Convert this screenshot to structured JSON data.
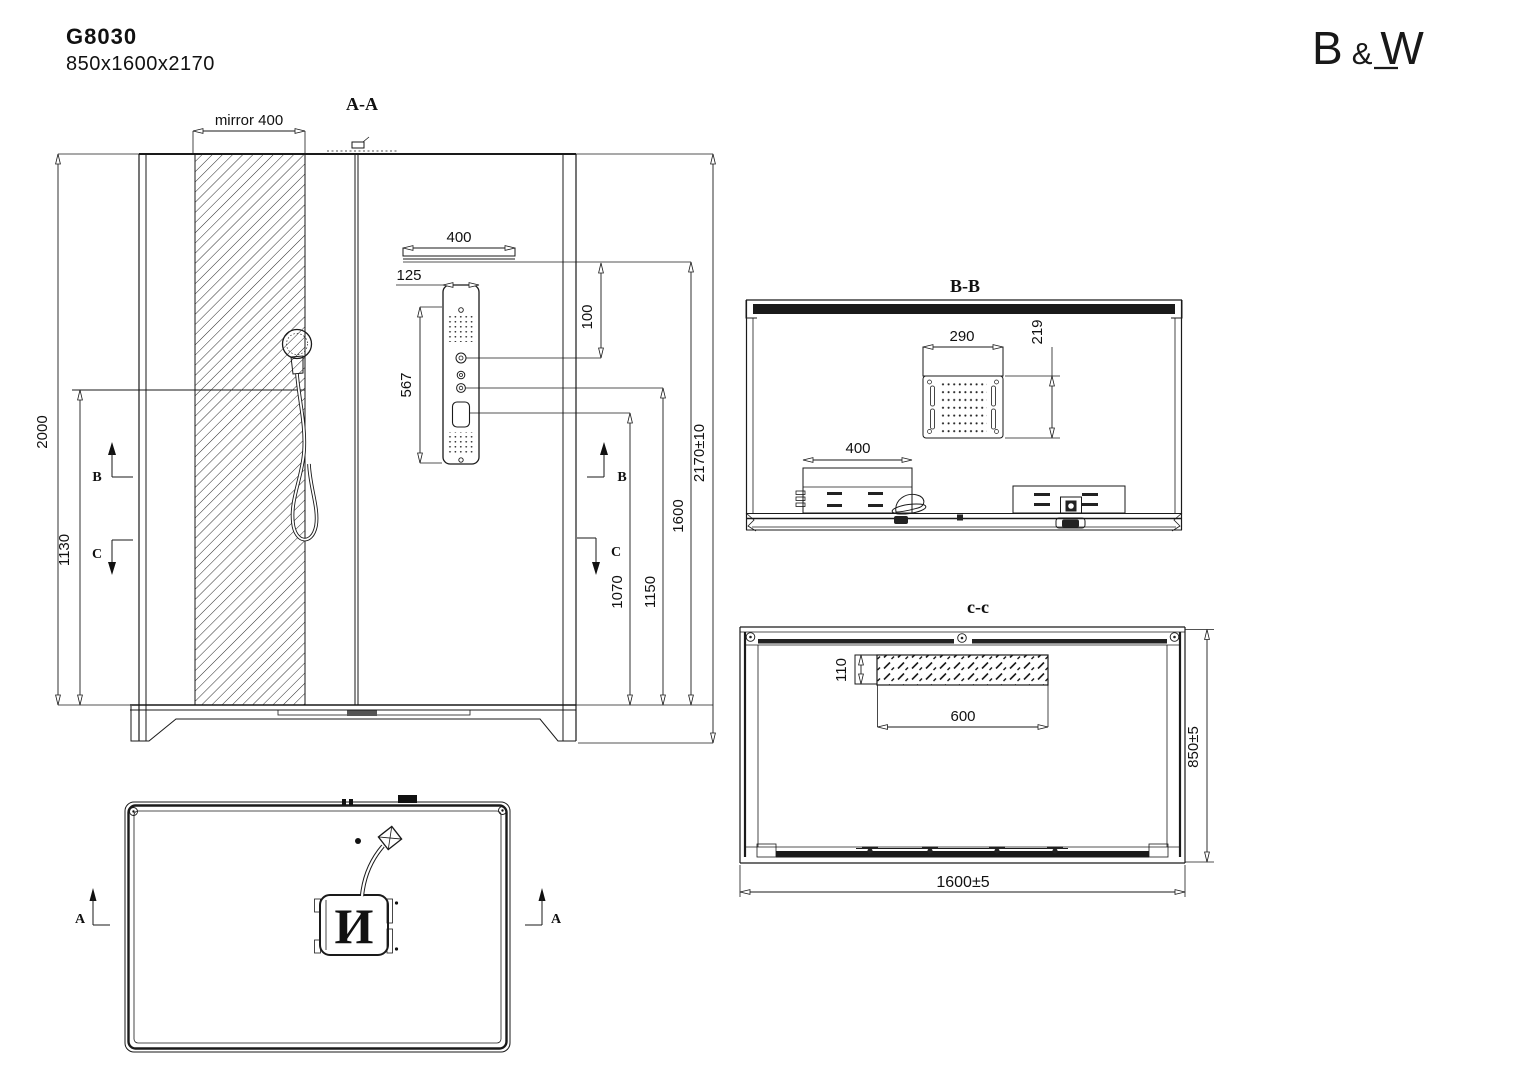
{
  "header": {
    "model": "G8030",
    "size": "850x1600x2170"
  },
  "logo": {
    "letter_b": "B",
    "ampersand": "&",
    "letter_w": "W"
  },
  "front_view": {
    "label": "A-A",
    "mirror_label": "mirror 400",
    "dims": {
      "cabin_height": "2000",
      "lower_zone_height": "1130",
      "shower_bar_width": "400",
      "panel_top_offset": "125",
      "panel_height": "567",
      "bar_to_panel_gap": "100",
      "display_height": "1070",
      "knob_height": "1150",
      "bar_height": "1600",
      "overall_height": "2170±10"
    },
    "marker_b": "B",
    "marker_c": "C"
  },
  "section_bb": {
    "label": "B-B",
    "dims": {
      "rain_head_width": "290",
      "rain_head_depth": "219",
      "shelf_width": "400"
    }
  },
  "section_cc": {
    "label": "c-c",
    "dims": {
      "mirror_offset": "110",
      "mirror_width": "600",
      "cabin_depth": "850±5",
      "cabin_width": "1600±5"
    }
  },
  "plan_view": {
    "marker_a": "A",
    "steam_unit_label": "И"
  }
}
